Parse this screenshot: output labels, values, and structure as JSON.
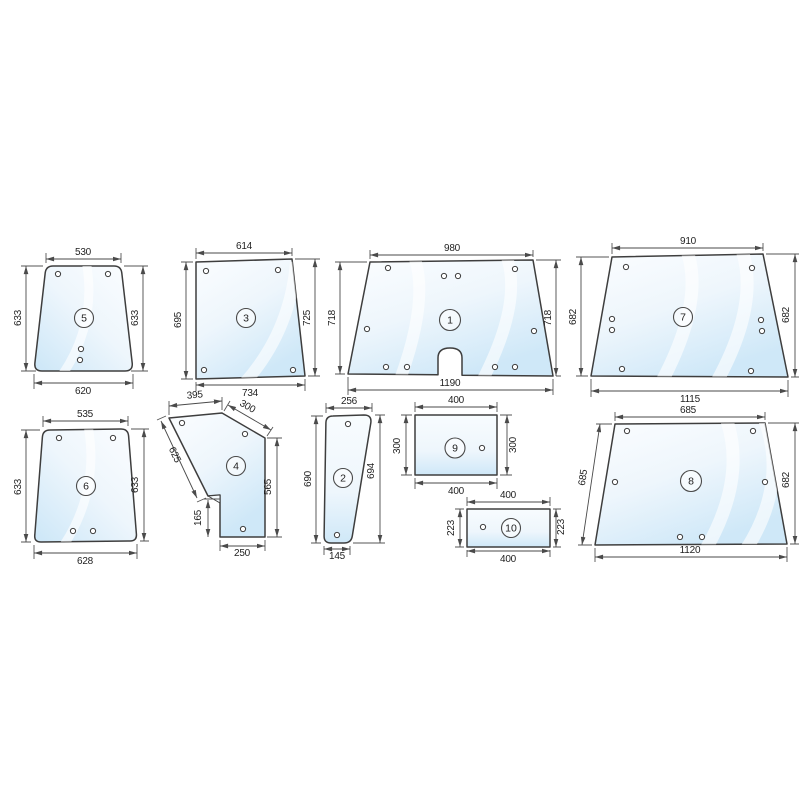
{
  "colors": {
    "background": "#ffffff",
    "glass_tint_light": "#fbfdff",
    "glass_tint_mid": "#eef6fc",
    "glass_tint_deep": "#cfe8f8",
    "line": "#4a4a4a",
    "text": "#1f1f1f"
  },
  "pieces": {
    "p1": {
      "number": "1",
      "dim_top": "980",
      "dim_bottom": "1190",
      "dim_left": "718",
      "dim_right": "718"
    },
    "p2": {
      "number": "2",
      "dim_top": "256",
      "dim_bottom": "145",
      "dim_left": "690",
      "dim_right": "694"
    },
    "p3": {
      "number": "3",
      "dim_top": "614",
      "dim_bottom": "734",
      "dim_left": "695",
      "dim_right": "725"
    },
    "p4": {
      "number": "4",
      "dim_top": "395",
      "dim_top_slant": "300",
      "dim_diagonal": "625",
      "dim_right": "565",
      "dim_left_lower": "165",
      "dim_bottom": "250"
    },
    "p5": {
      "number": "5",
      "dim_top": "530",
      "dim_bottom": "620",
      "dim_left": "633",
      "dim_right": "633"
    },
    "p6": {
      "number": "6",
      "dim_top": "535",
      "dim_bottom": "628",
      "dim_left": "633",
      "dim_right": "633"
    },
    "p7": {
      "number": "7",
      "dim_top": "910",
      "dim_bottom": "1115",
      "dim_left": "682",
      "dim_right": "682"
    },
    "p8": {
      "number": "8",
      "dim_top": "685",
      "dim_bottom": "1120",
      "dim_left": "685",
      "dim_right": "682"
    },
    "p9": {
      "number": "9",
      "dim_top": "400",
      "dim_bottom": "400",
      "dim_left": "300",
      "dim_right": "300"
    },
    "p10": {
      "number": "10",
      "dim_top": "400",
      "dim_bottom": "400",
      "dim_left": "223",
      "dim_right": "223"
    }
  }
}
